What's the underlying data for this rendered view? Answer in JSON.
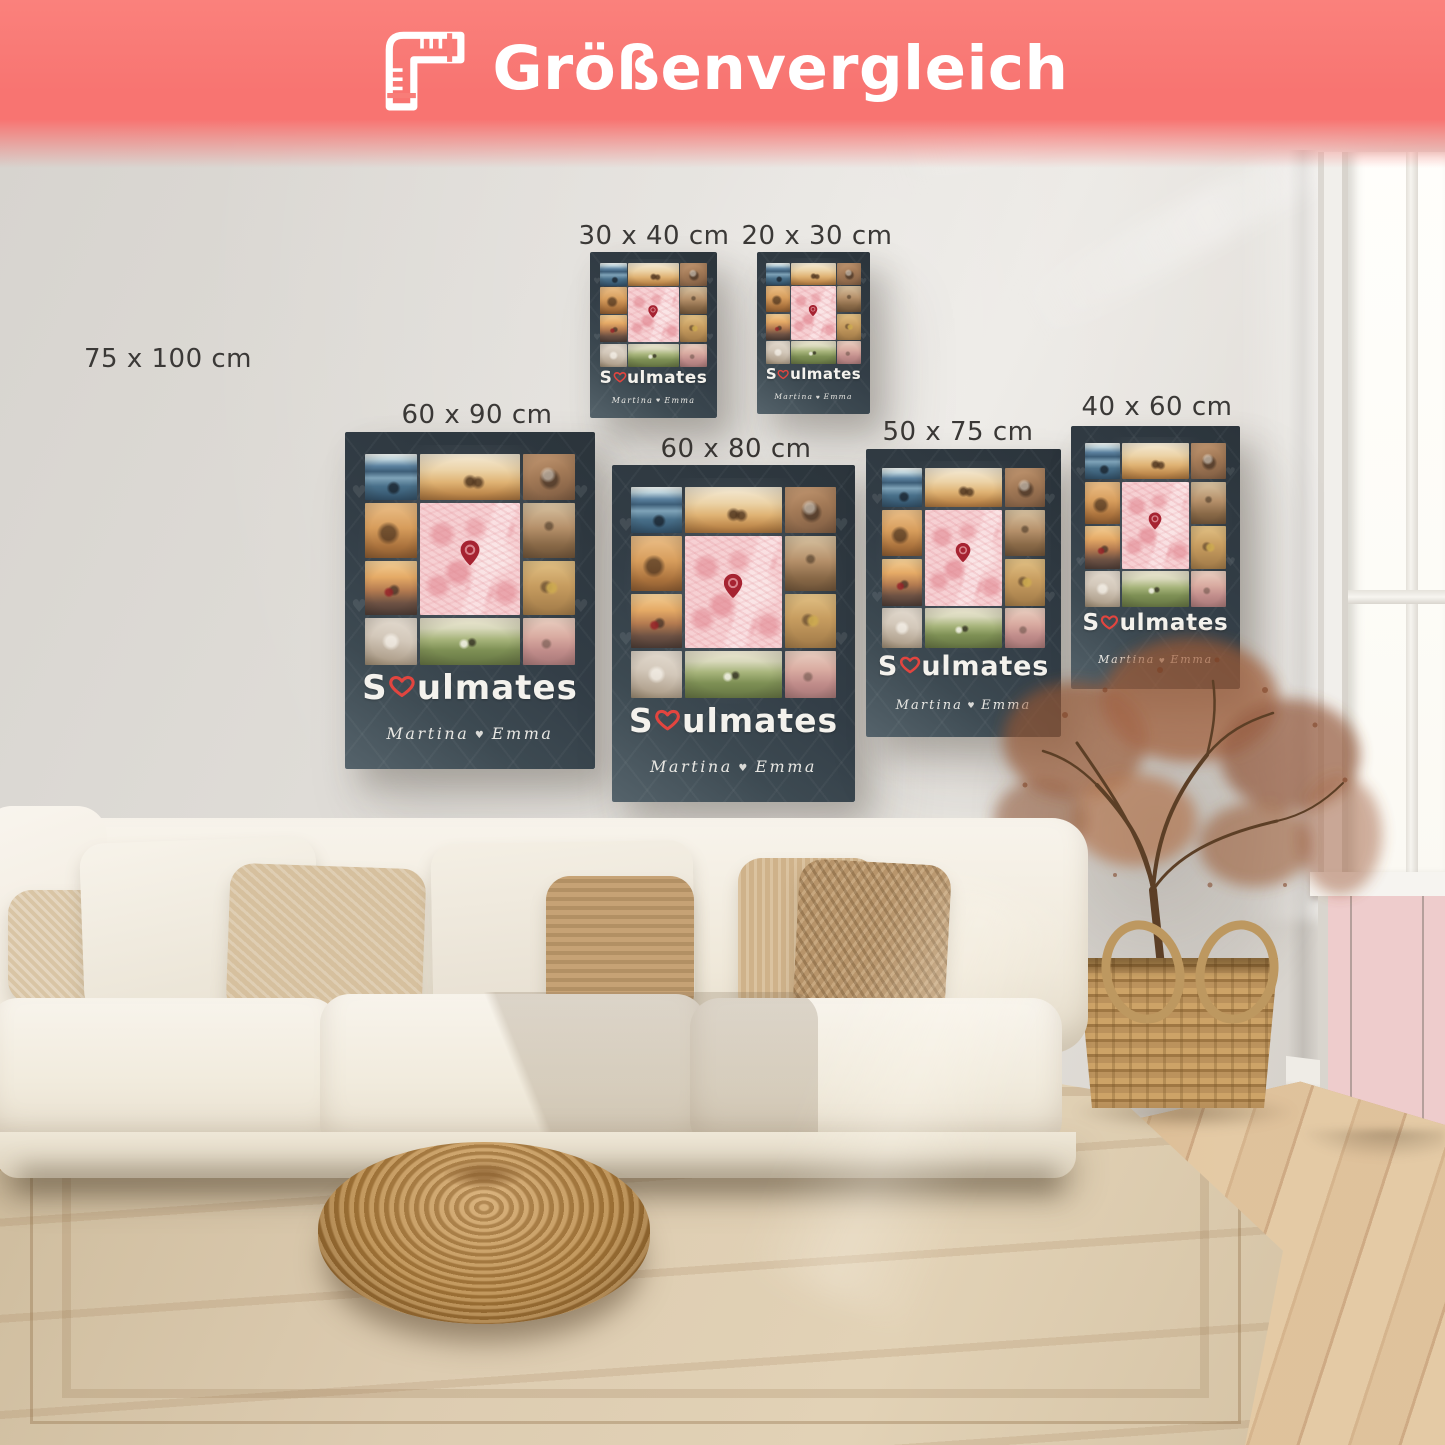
{
  "header": {
    "title": "Größenvergleich",
    "icon": "ruler-icon",
    "background_color": "#F87471",
    "text_color": "#FFFFFF"
  },
  "size_labels": {
    "s75x100": "75 x 100 cm",
    "s30x40": "30 x 40 cm",
    "s20x30": "20 x 30 cm",
    "s60x90": "60 x 90 cm",
    "s60x80": "60 x 80 cm",
    "s50x75": "50 x 75 cm",
    "s40x60": "40 x 60 cm"
  },
  "poster": {
    "title_lead": "S",
    "title_rest": "ulmates",
    "title_full": "Soulmates",
    "name_left": "Martina",
    "names_separator": "♥",
    "name_right": "Emma",
    "colors": {
      "background": "#313C44",
      "map": "#F3C8CB",
      "pin": "#A62331",
      "title_heart": "#E2453F",
      "title_text": "#F4F2ED"
    }
  },
  "decor": {
    "heart_glyph": "♥"
  },
  "icons": [
    "ruler-icon",
    "heart-icon",
    "location-pin-icon"
  ]
}
